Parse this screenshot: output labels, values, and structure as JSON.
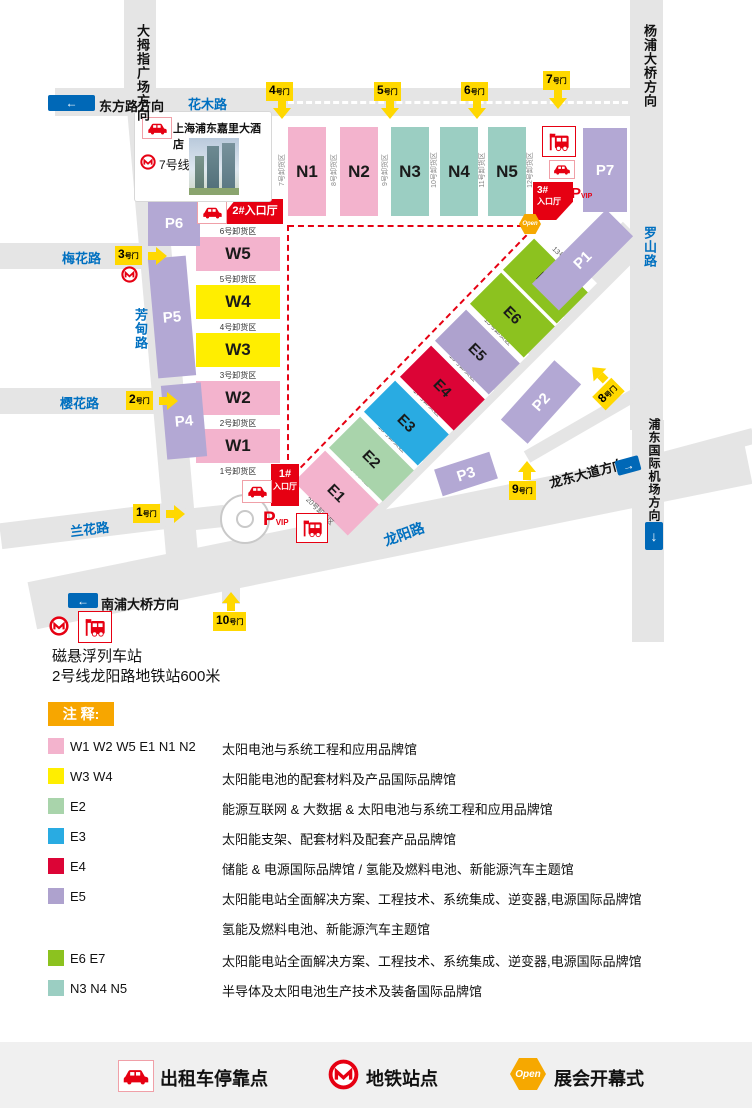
{
  "colors": {
    "pink_hall": "#F3B3CD",
    "yellow_hall": "#FFEE00",
    "teal_hall": "#9BCEC2",
    "e2_green": "#A9D4AB",
    "e3_blue": "#29ABE2",
    "e4_red": "#DC0436",
    "e5_purple": "#AEA2CE",
    "e6_green": "#8CC21F",
    "parking_purple": "#B3A8D4",
    "road_gray": "#E5E5E5",
    "entrance_red": "#E60012",
    "gate_yellow": "#FFD800",
    "road_label_blue": "#0070C0",
    "sign_blue": "#0068B7",
    "legend_orange": "#F7A600",
    "open_orange": "#F6A800"
  },
  "map": {
    "roads": {
      "huamu": "花木路",
      "meihua": "梅花路",
      "yinghua": "樱花路",
      "lanhua": "兰花路",
      "fangdian": "芳甸路",
      "luoshan": "罗山路",
      "longyang": "龙阳路"
    },
    "directions": {
      "dongfang": "东方路方向",
      "damuzhi": "大拇指广场方向",
      "yangpu": "杨浦大桥方向",
      "pudong_airport": "浦东国际机场方向",
      "longdong": "龙东大道方向",
      "nanpu": "南浦大桥方向",
      "arrow_left": "←",
      "arrow_right": "→",
      "arrow_down": "↓"
    },
    "hotel": {
      "name": "上海浦东嘉里大酒店",
      "metro_line": "7号线"
    },
    "transit_note": {
      "maglev": "磁悬浮列车站",
      "metro2": "2号线龙阳路地铁站600米"
    },
    "gates": [
      {
        "num": "1",
        "suffix": "号门"
      },
      {
        "num": "2",
        "suffix": "号门"
      },
      {
        "num": "3",
        "suffix": "号门"
      },
      {
        "num": "4",
        "suffix": "号门"
      },
      {
        "num": "5",
        "suffix": "号门"
      },
      {
        "num": "6",
        "suffix": "号门"
      },
      {
        "num": "7",
        "suffix": "号门"
      },
      {
        "num": "8",
        "suffix": "号门"
      },
      {
        "num": "9",
        "suffix": "号门"
      },
      {
        "num": "10",
        "suffix": "号门"
      }
    ],
    "n_halls": [
      {
        "code": "N1",
        "dock": "7号卸货区"
      },
      {
        "code": "N2",
        "dock": "8号卸货区"
      },
      {
        "code": "N3",
        "dock": "9号卸货区"
      },
      {
        "code": "N4",
        "dock": "10号卸货区"
      },
      {
        "code": "N5",
        "dock": "11号卸货区"
      }
    ],
    "w_halls": [
      {
        "code": "W5",
        "dock": "6号卸货区"
      },
      {
        "code": "W4",
        "dock": "5号卸货区"
      },
      {
        "code": "W3",
        "dock": "4号卸货区"
      },
      {
        "code": "W2",
        "dock": "3号卸货区"
      },
      {
        "code": "W1",
        "dock": "2号卸货区"
      }
    ],
    "e_halls": [
      {
        "code": "E1",
        "dock": "19号卸货区"
      },
      {
        "code": "E2",
        "dock": "18号卸货区"
      },
      {
        "code": "E3",
        "dock": "17号卸货区"
      },
      {
        "code": "E4",
        "dock": "16号卸货区"
      },
      {
        "code": "E5",
        "dock": "15号卸货区"
      },
      {
        "code": "E6",
        "dock": "14号卸货区"
      },
      {
        "code": "E7",
        "dock": "13号卸货区"
      }
    ],
    "extra_docks": {
      "n_right": "12号卸货区",
      "w_bottom": "1号卸货区",
      "e_bottom": "20号卸货区"
    },
    "parkings": [
      "P1",
      "P2",
      "P3",
      "P4",
      "P5",
      "P6",
      "P7"
    ],
    "vip": {
      "p": "P",
      "vip": "VIP"
    },
    "entrances": {
      "one_num": "1#",
      "one_hall": "入口厅",
      "two": "2#入口厅",
      "three_num": "3#",
      "three_hall": "入口厅"
    },
    "open_label": "Open"
  },
  "legend": {
    "title": "注 释:",
    "rows": [
      {
        "codes": "W1 W2 W5 E1 N1 N2",
        "desc": "太阳电池与系统工程和应用品牌馆",
        "color": "#F3B3CD"
      },
      {
        "codes": "W3 W4",
        "desc": "太阳能电池的配套材料及产品国际品牌馆",
        "color": "#FFEE00"
      },
      {
        "codes": "E2",
        "desc": "能源互联网 & 大数据 & 太阳电池与系统工程和应用品牌馆",
        "color": "#A9D4AB"
      },
      {
        "codes": "E3",
        "desc": "太阳能支架、配套材料及配套产品品牌馆",
        "color": "#29ABE2"
      },
      {
        "codes": "E4",
        "desc": "储能 & 电源国际品牌馆 / 氢能及燃料电池、新能源汽车主题馆",
        "color": "#DC0436"
      },
      {
        "codes": "E5",
        "desc": "太阳能电站全面解决方案、工程技术、系统集成、逆变器,电源国际品牌馆",
        "desc2": "氢能及燃料电池、新能源汽车主题馆",
        "color": "#AEA2CE"
      },
      {
        "codes": "E6 E7",
        "desc": "太阳能电站全面解决方案、工程技术、系统集成、逆变器,电源国际品牌馆",
        "color": "#8CC21F"
      },
      {
        "codes": "N3 N4 N5",
        "desc": "半导体及太阳电池生产技术及装备国际品牌馆",
        "color": "#9BCEC2"
      }
    ]
  },
  "footer": {
    "taxi": "出租车停靠点",
    "metro": "地铁站点",
    "open": "展会开幕式"
  }
}
